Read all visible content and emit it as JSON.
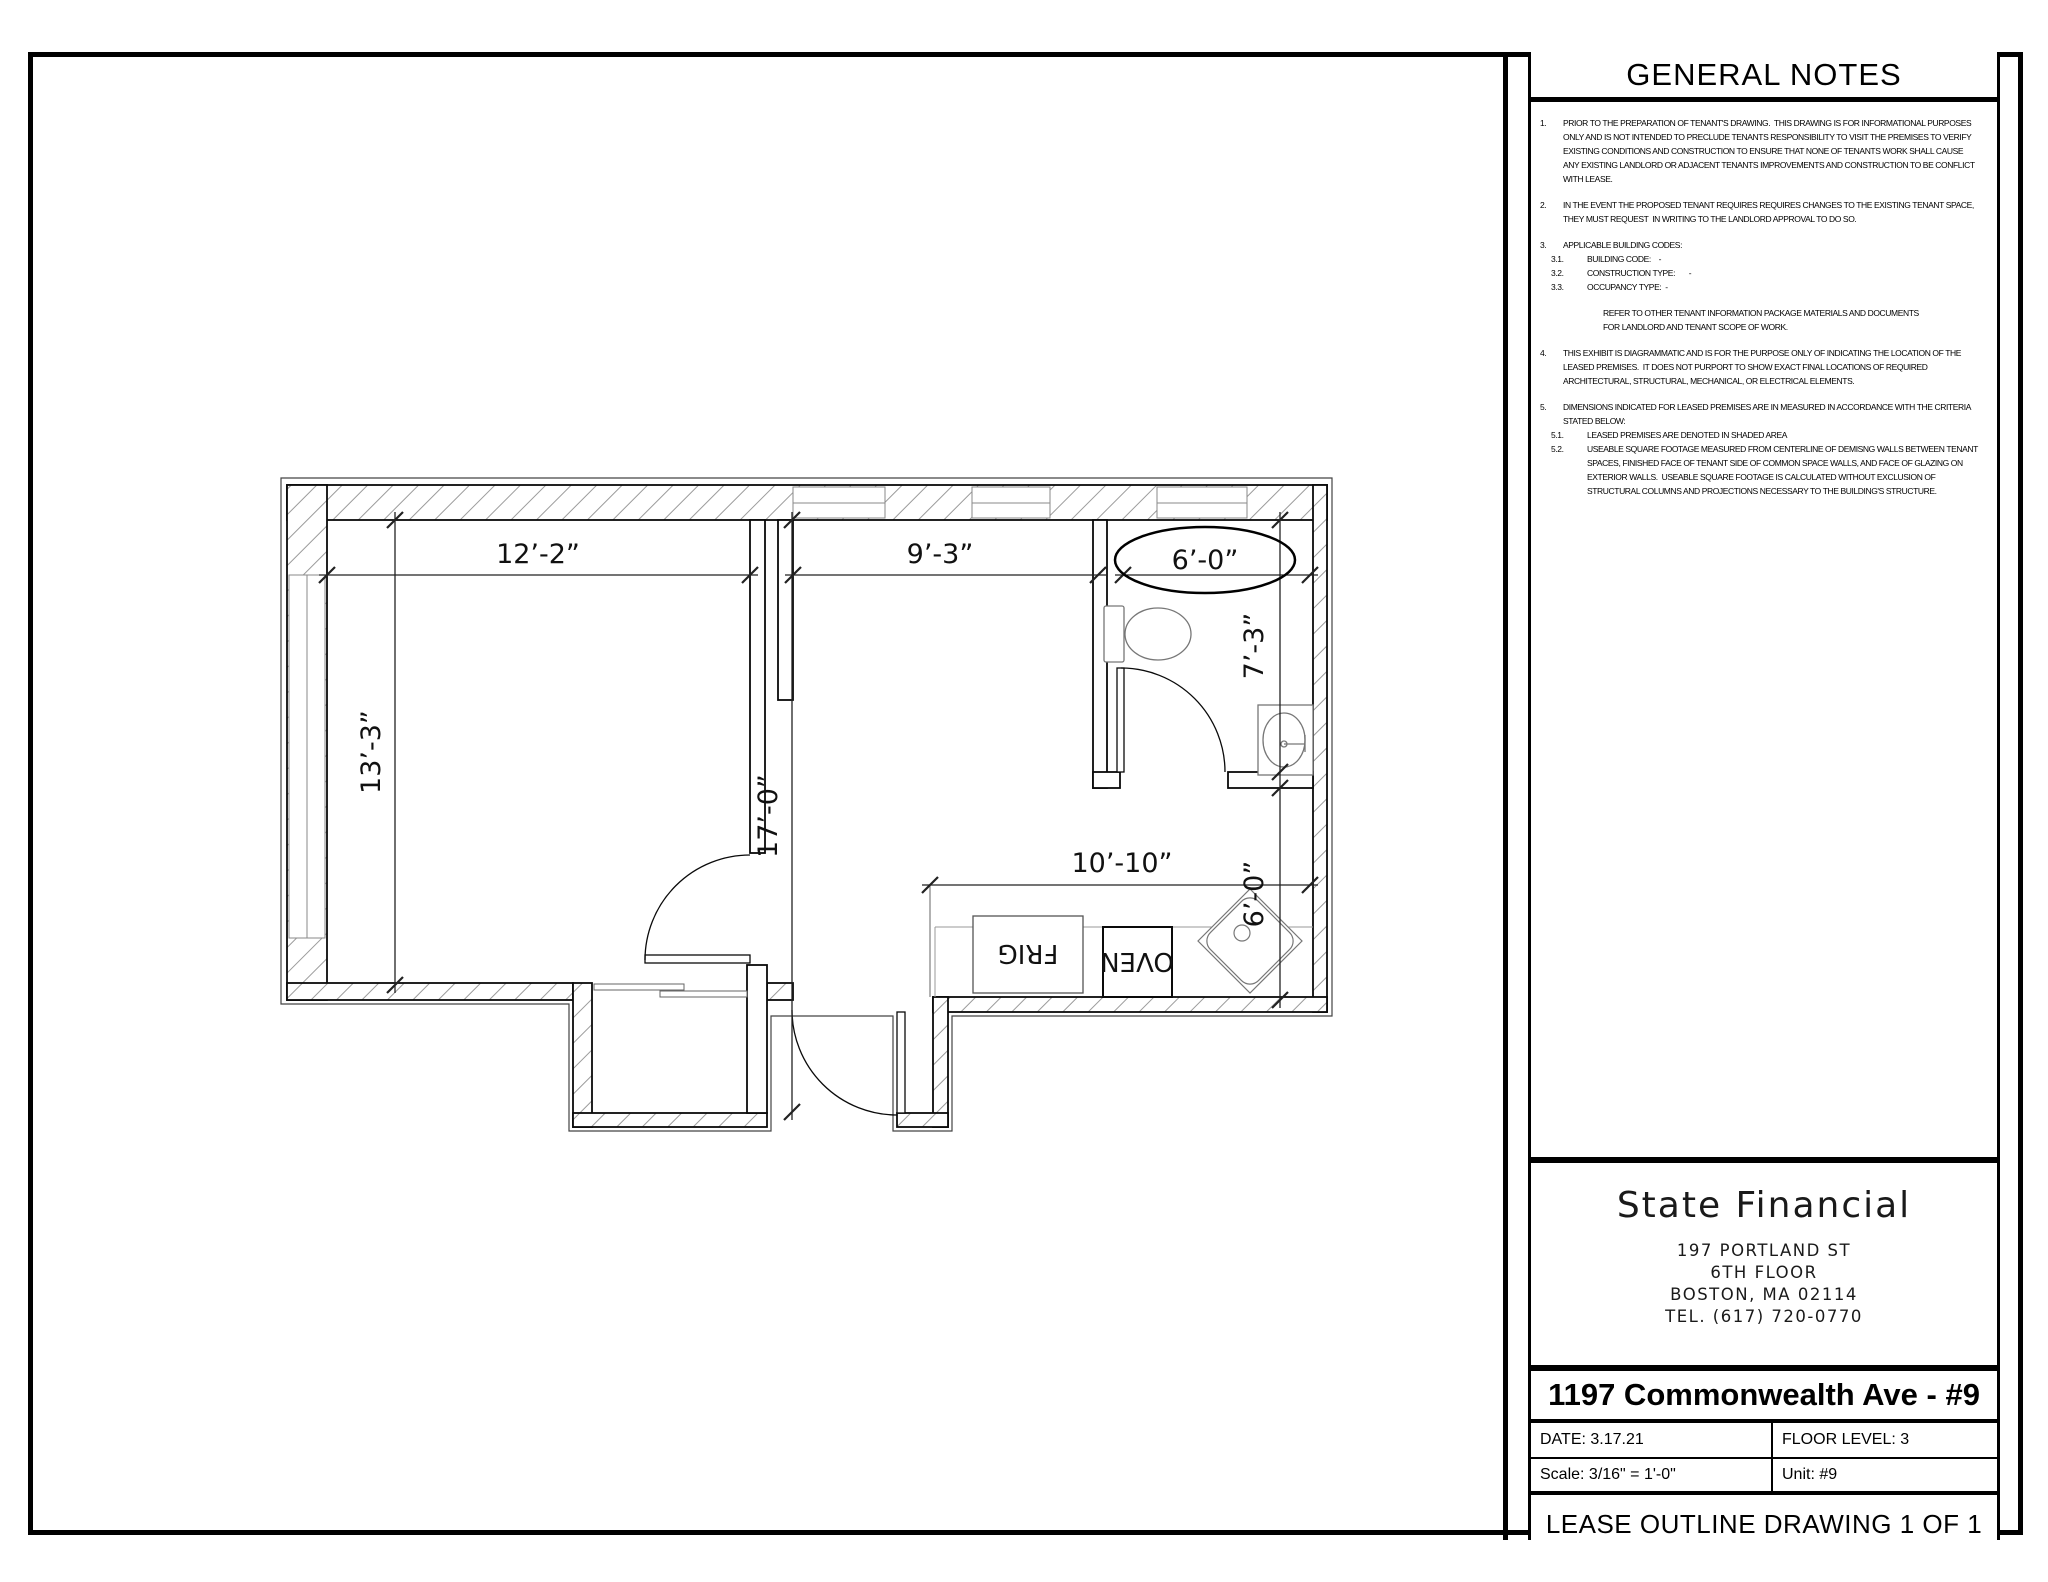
{
  "drawing": {
    "general_notes": {
      "title": "GENERAL NOTES",
      "items": [
        {
          "num": "1.",
          "text": "PRIOR TO THE PREPARATION OF TENANT'S DRAWING.  THIS DRAWING IS FOR INFORMATIONAL PURPOSES\nONLY AND IS NOT INTENDED TO PRECLUDE TENANTS RESPONSIBILITY TO VISIT THE PREMISES TO VERIFY\nEXISTING CONDITIONS AND CONSTRUCTION TO ENSURE THAT NONE OF TENANTS WORK SHALL CAUSE\nANY EXISTING LANDLORD OR ADJACENT TENANTS IMPROVEMENTS AND CONSTRUCTION TO BE CONFLICT\nWITH LEASE."
        },
        {
          "num": "2.",
          "text": "IN THE EVENT THE PROPOSED TENANT REQUIRES REQUIRES CHANGES TO THE EXISTING TENANT SPACE,\nTHEY MUST REQUEST  IN WRITING TO THE LANDLORD APPROVAL TO DO SO."
        },
        {
          "num": "3.",
          "text": "APPLICABLE BUILDING CODES:",
          "subs": [
            {
              "num": "3.1.",
              "text": "BUILDING CODE:    -"
            },
            {
              "num": "3.2.",
              "text": "CONSTRUCTION TYPE:       -"
            },
            {
              "num": "3.3.",
              "text": "OCCUPANCY TYPE:  -"
            }
          ],
          "extra": "REFER TO OTHER TENANT INFORMATION PACKAGE MATERIALS AND DOCUMENTS\nFOR LANDLORD AND TENANT SCOPE OF WORK."
        },
        {
          "num": "4.",
          "text": "THIS EXHIBIT IS DIAGRAMMATIC AND IS FOR THE PURPOSE ONLY OF INDICATING THE LOCATION OF THE\nLEASED PREMISES.  IT DOES NOT PURPORT TO SHOW EXACT FINAL LOCATIONS OF REQUIRED\nARCHITECTURAL, STRUCTURAL, MECHANICAL, OR ELECTRICAL ELEMENTS."
        },
        {
          "num": "5.",
          "text": "DIMENSIONS INDICATED FOR LEASED PREMISES ARE IN MEASURED IN ACCORDANCE WITH THE CRITERIA\nSTATED BELOW:",
          "subs": [
            {
              "num": "5.1.",
              "text": "LEASED PREMISES ARE DENOTED IN SHADED AREA"
            },
            {
              "num": "5.2.",
              "text": "USEABLE SQUARE FOOTAGE MEASURED FROM CENTERLINE OF DEMISNG WALLS BETWEEN TENANT\nSPACES, FINISHED FACE OF TENANT SIDE OF COMMON SPACE WALLS, AND FACE OF GLAZING ON\nEXTERIOR WALLS.  USEABLE SQUARE FOOTAGE IS CALCULATED WITHOUT EXCLUSION OF\nSTRUCTURAL COLUMNS AND PROJECTIONS NECESSARY TO THE BUILDING'S STRUCTURE."
            }
          ]
        }
      ]
    },
    "title_block": {
      "company": "State Financial",
      "address_lines": [
        "197 PORTLAND ST",
        "6TH FLOOR",
        "BOSTON, MA 02114",
        "TEL. (617) 720-0770"
      ],
      "project_title": "1197 Commonwealth Ave - #9",
      "date": "DATE: 3.17.21",
      "floor_level": "FLOOR LEVEL: 3",
      "scale": "Scale:  3/16\" = 1'-0\"",
      "unit": "Unit: #9",
      "sheet_name": "LEASE OUTLINE DRAWING 1 OF 1"
    },
    "plan": {
      "dims": {
        "living_width": "12’-2”",
        "mid_width": "9’-3”",
        "bath_width": "6’-0”",
        "living_height": "13’-3”",
        "overall_depth": "17’-0”",
        "bath_depth": "7’-3”",
        "kitchen_width": "10’-10”",
        "kitchen_depth": "6’-0”"
      },
      "labels": {
        "fridge": "FRIG",
        "oven": "OVEN"
      }
    }
  }
}
